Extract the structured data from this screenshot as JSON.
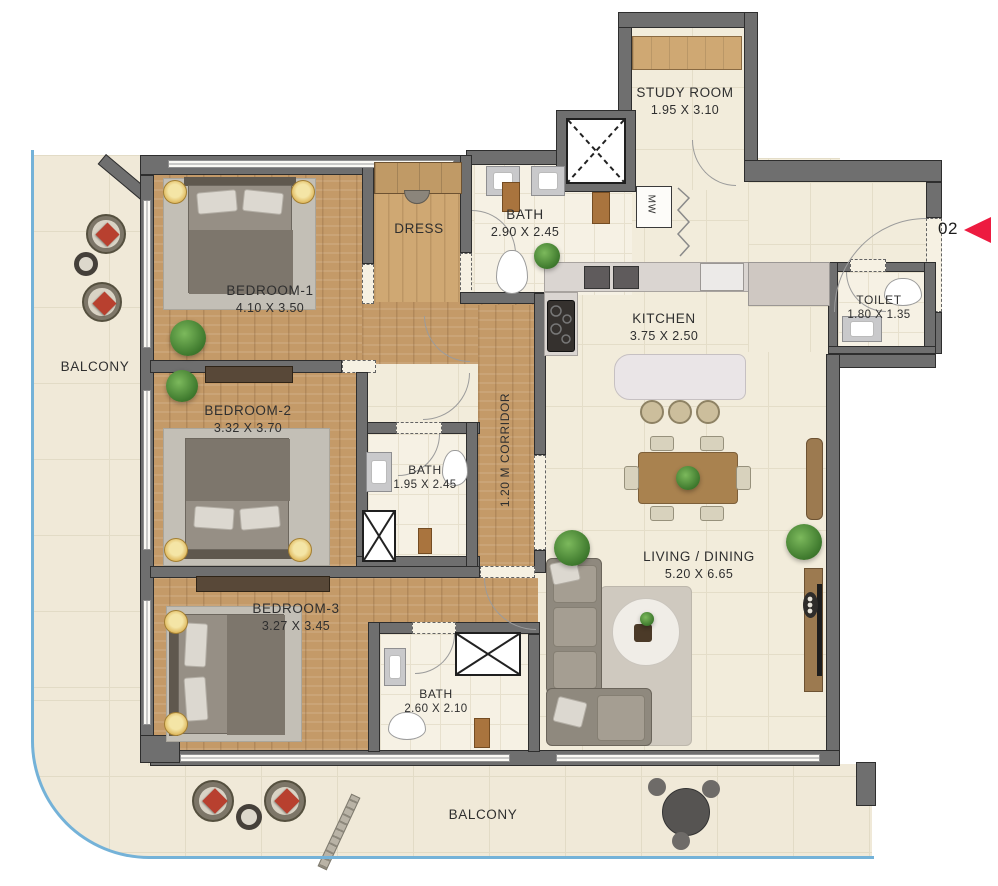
{
  "floor_plan": {
    "unit": {
      "number": "02"
    },
    "rooms": {
      "study_room": {
        "label": "STUDY ROOM",
        "dimensions": "1.95 X 3.10"
      },
      "bath_master": {
        "label": "BATH",
        "dimensions": "2.90 X 2.45"
      },
      "dress": {
        "label": "DRESS"
      },
      "bedroom_1": {
        "label": "BEDROOM-1",
        "dimensions": "4.10 X 3.50"
      },
      "kitchen": {
        "label": "KITCHEN",
        "dimensions": "3.75 X 2.50"
      },
      "toilet": {
        "label": "TOILET",
        "dimensions": "1.80 X 1.35"
      },
      "bedroom_2": {
        "label": "BEDROOM-2",
        "dimensions": "3.32 X 3.70"
      },
      "bath_2": {
        "label": "BATH",
        "dimensions": "1.95 X 2.45"
      },
      "corridor": {
        "label": "1.20 M CORRIDOR"
      },
      "bedroom_3": {
        "label": "BEDROOM-3",
        "dimensions": "3.27 X 3.45"
      },
      "bath_3": {
        "label": "BATH",
        "dimensions": "2.60 X 2.10"
      },
      "living_dining": {
        "label": "LIVING / DINING",
        "dimensions": "5.20 X 6.65"
      },
      "balcony_left": {
        "label": "BALCONY"
      },
      "balcony_bottom": {
        "label": "BALCONY"
      }
    },
    "appliances": {
      "microwave": "MW"
    },
    "colors": {
      "wall": "#6f6f6f",
      "wood_floor": "#c49a68",
      "tile_floor": "#f2ecdb",
      "balcony_edge": "#74b2d8",
      "unit_arrow_red": "#ed1b40"
    }
  }
}
